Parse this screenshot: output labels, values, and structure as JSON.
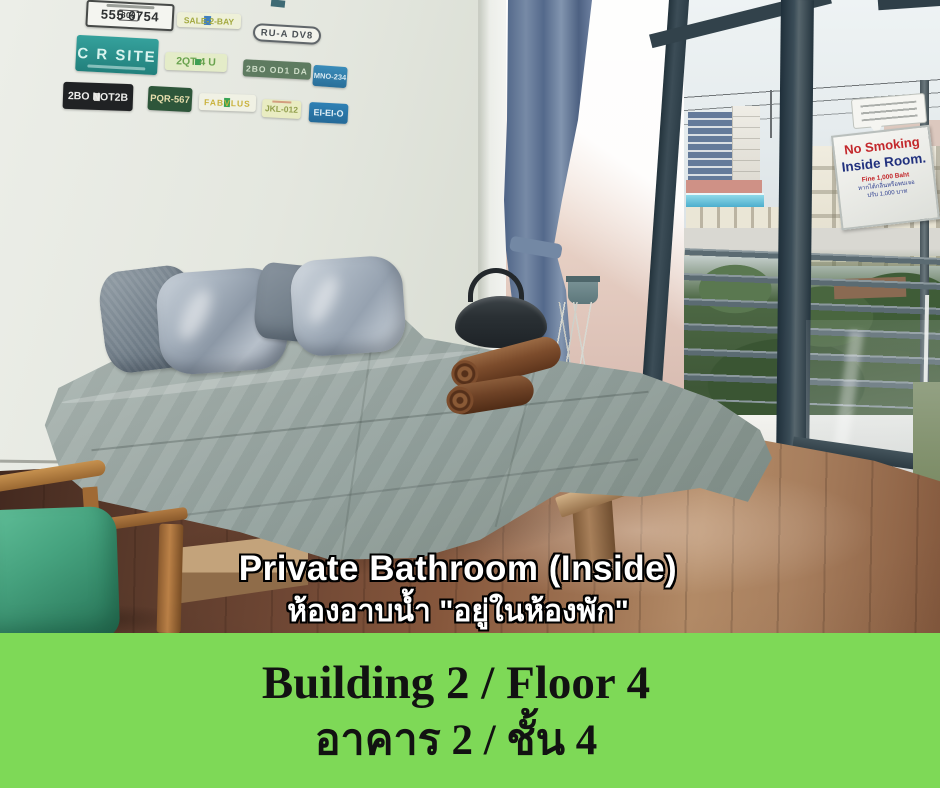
{
  "photo": {
    "plates": [
      {
        "prefix": "800",
        "text": "555 6754"
      },
      {
        "text": "SALE-2-BAY"
      },
      {
        "text": "RU-A DV8"
      },
      {
        "text": "C R SITE"
      },
      {
        "text": "2QT 4 U"
      },
      {
        "text": "2BO OD1 DA"
      },
      {
        "text": "MNO-234"
      },
      {
        "text": "2BO NOT2B"
      },
      {
        "text": "PQR-567"
      },
      {
        "text": "FABVLUS"
      },
      {
        "text": "JKL-012"
      },
      {
        "text": "EI-EI-O"
      }
    ],
    "no_smoking_sign": {
      "title": "No Smoking",
      "subtitle": "Inside Room.",
      "fine": "Fine 1,000 Baht",
      "thai1": "หากได้กลิ่นหรือพบเจอ",
      "thai2": "ปรับ 1,000 บาท"
    },
    "overlay": {
      "title": "Private Bathroom (Inside)",
      "subtitle": "ห้องอาบน้ำ \"อยู่ในห้องพัก\""
    }
  },
  "banner": {
    "line1": "Building 2 / Floor 4",
    "line2": "อาคาร 2 / ชั้น 4"
  },
  "colors": {
    "banner_green": "#7ed957",
    "sign_red": "#c3272b",
    "sign_navy": "#21317e",
    "curtain_blue": "#5d7494",
    "chair_green": "#3f9e7d"
  }
}
